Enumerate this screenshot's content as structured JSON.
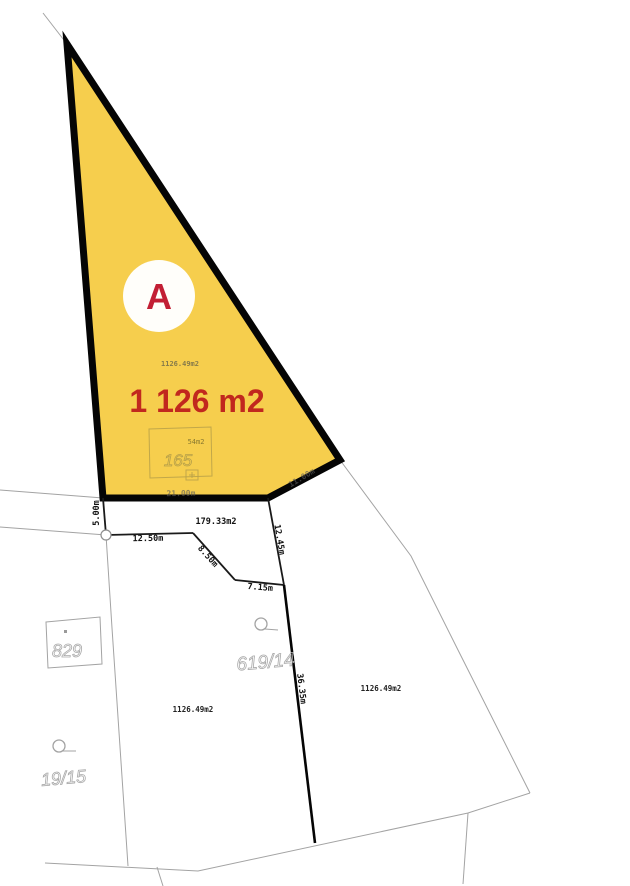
{
  "map": {
    "type": "cadastral-parcel-map",
    "colors": {
      "highlight_fill": "#F6CE4D",
      "highlight_outline": "#000000",
      "accent_red": "#C1281E",
      "badge_red": "#C21F34",
      "parcel_line_gray": "#A3A3A3"
    },
    "highlighted_plot": {
      "badge": "A",
      "area_big": "1 126 m2",
      "area_small": "1126.49m2",
      "building": {
        "number": "165",
        "area": "54m2"
      }
    },
    "dimensions": {
      "bottom_edge": "21.00m",
      "left_short": "5.00m",
      "seg_12_50": "12.50m",
      "seg_8_50": "8.50m",
      "seg_7_15": "7.15m",
      "seg_12_45": "12.45m",
      "seg_36_35": "36.35m",
      "diag_faint": "11.00m"
    },
    "parcels": {
      "strip_area": "179.33m2",
      "middle": {
        "number": "619/14",
        "area": "1126.49m2"
      },
      "right_area": "1126.49m2",
      "left": {
        "number": "19/15",
        "building_box": "829"
      }
    }
  }
}
